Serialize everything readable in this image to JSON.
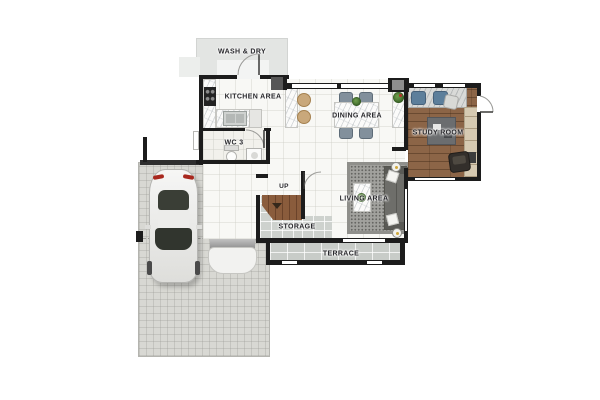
{
  "plan": {
    "title": "Ground floor plan",
    "rooms": {
      "wash_dry": {
        "label": "WASH & DRY"
      },
      "kitchen": {
        "label": "KITCHEN AREA"
      },
      "wc3": {
        "label": "WC 3"
      },
      "dining": {
        "label": "DINING AREA"
      },
      "study": {
        "label": "STUDY ROOM"
      },
      "living": {
        "label": "LIVING AREA"
      },
      "stairs": {
        "label": "UP"
      },
      "storage": {
        "label": "STORAGE"
      },
      "terrace": {
        "label": "TERRACE"
      }
    },
    "colors": {
      "wall": "#1c1c1c",
      "wood_floor": "#8c6547",
      "storage_tile": "#ced2ce",
      "terrace_tile": "#c8ccc8",
      "driveway": "#d8d8d3",
      "rug": "#a1a19d",
      "stair_wood": "#8a5c3c",
      "dining_chair": "#82909c",
      "study_chair": "#5d7f9b",
      "stool": "#c9a87b"
    }
  }
}
